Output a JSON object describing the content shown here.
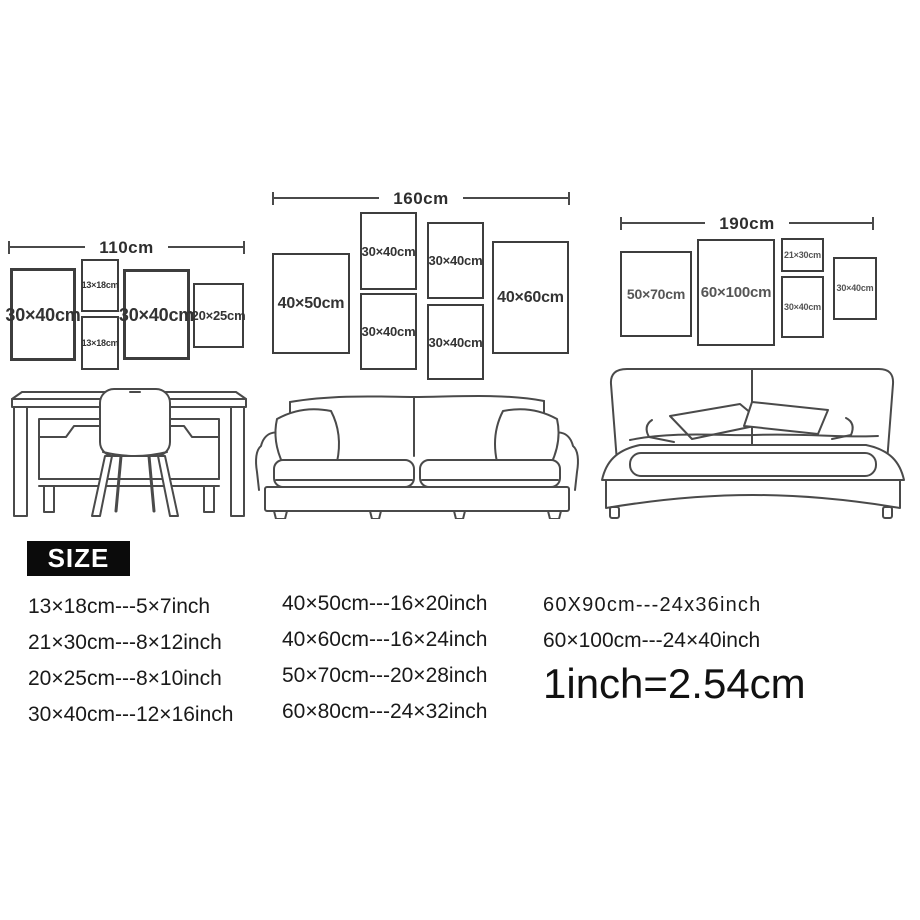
{
  "page": {
    "background": "#ffffff",
    "line_color": "#4a4a4a",
    "text_color": "#1f1f1f",
    "badge_bg": "#0b0b0b",
    "badge_text_color": "#ffffff"
  },
  "groups": [
    {
      "name": "desk-wall",
      "dimension_label": "110cm",
      "furniture": "desk-with-chair",
      "frames": [
        {
          "label": "30×40cm"
        },
        {
          "label": "13×18cm"
        },
        {
          "label": "13×18cm"
        },
        {
          "label": "30×40cm"
        },
        {
          "label": "20×25cm"
        }
      ]
    },
    {
      "name": "sofa-wall",
      "dimension_label": "160cm",
      "furniture": "sofa",
      "frames": [
        {
          "label": "40×50cm"
        },
        {
          "label": "30×40cm"
        },
        {
          "label": "30×40cm"
        },
        {
          "label": "30×40cm"
        },
        {
          "label": "30×40cm"
        },
        {
          "label": "40×60cm"
        }
      ]
    },
    {
      "name": "bed-wall",
      "dimension_label": "190cm",
      "furniture": "bed",
      "frames": [
        {
          "label": "50×70cm"
        },
        {
          "label": "60×100cm"
        },
        {
          "label": "21×30cm"
        },
        {
          "label": "30×40cm"
        },
        {
          "label": "30×40cm"
        }
      ]
    }
  ],
  "size_section": {
    "badge": "SIZE",
    "col1": [
      "13×18cm---5×7inch",
      "21×30cm---8×12inch",
      "20×25cm---8×10inch",
      "30×40cm---12×16inch"
    ],
    "col2": [
      "40×50cm---16×20inch",
      "40×60cm---16×24inch",
      "50×70cm---20×28inch",
      "60×80cm---24×32inch"
    ],
    "col3": [
      "60X90cm---24x36inch",
      "60×100cm---24×40inch"
    ],
    "conversion": "1inch=2.54cm"
  }
}
